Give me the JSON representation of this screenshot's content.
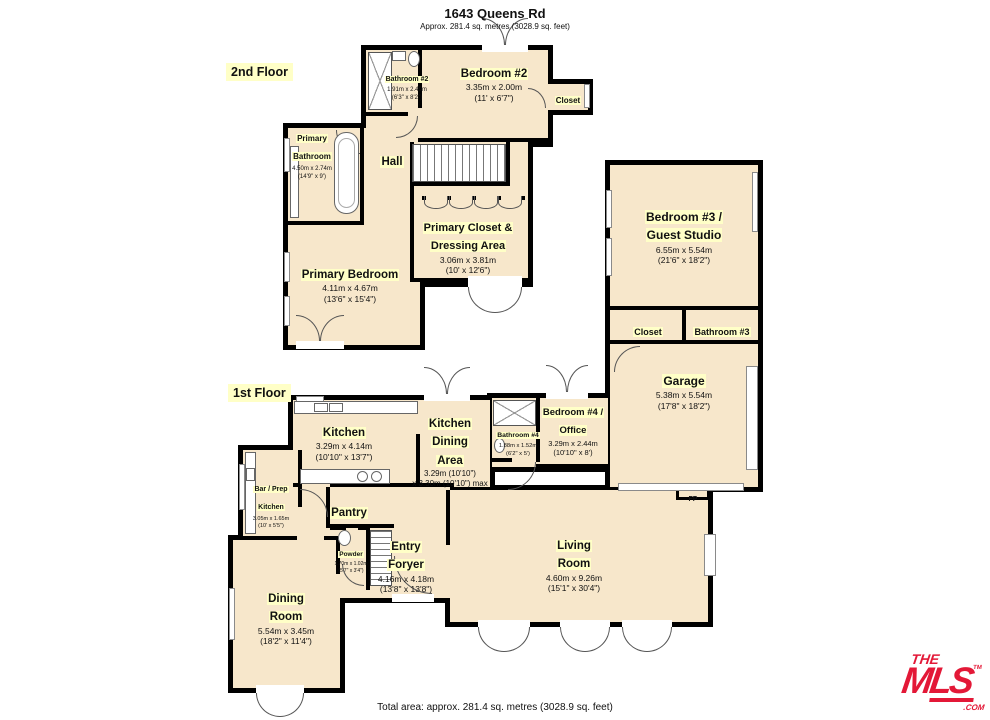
{
  "header": {
    "title": "1643 Queens Rd",
    "subtitle": "Approx. 281.4 sq. metres (3028.9 sq. feet)"
  },
  "floor_labels": {
    "second": "2nd Floor",
    "first": "1st Floor"
  },
  "rooms": {
    "bathroom2": {
      "name": "Bathroom #2",
      "dims_m": "1.91m x 2.49m",
      "dims_ft": "(6'3\" x 8'2\")"
    },
    "bedroom2": {
      "name": "Bedroom #2",
      "dims_m": "3.35m x 2.00m",
      "dims_ft": "(11' x 6'7\")"
    },
    "bedroom2_closet": {
      "name": "Closet"
    },
    "primary_bathroom": {
      "name": "Primary Bathroom",
      "dims_m": "4.50m x 2.74m",
      "dims_ft": "(14'9\" x 9')"
    },
    "hall": {
      "name": "Hall"
    },
    "primary_closet": {
      "name": "Primary Closet & Dressing Area",
      "dims_m": "3.06m x 3.81m",
      "dims_ft": "(10' x 12'6\")"
    },
    "primary_bedroom": {
      "name": "Primary Bedroom",
      "dims_m": "4.11m x 4.67m",
      "dims_ft": "(13'6\" x 15'4\")"
    },
    "bedroom3": {
      "name": "Bedroom #3 / Guest Studio",
      "dims_m": "6.55m x 5.54m",
      "dims_ft": "(21'6\" x 18'2\")"
    },
    "bedroom3_closet": {
      "name": "Closet"
    },
    "bathroom3": {
      "name": "Bathroom #3"
    },
    "garage": {
      "name": "Garage",
      "dims_m": "5.38m x 5.54m",
      "dims_ft": "(17'8\" x 18'2\")"
    },
    "kitchen": {
      "name": "Kitchen",
      "dims_m": "3.29m x 4.14m",
      "dims_ft": "(10'10\" x 13'7\")"
    },
    "kitchen_dining": {
      "name": "Kitchen Dining Area",
      "dims_m": "3.29m (10'10\")",
      "dims_ft": "x 3.30m (10'10\") max"
    },
    "bathroom4": {
      "name": "Bathroom #4",
      "dims_m": "1.88m x 1.52m",
      "dims_ft": "(6'2\" x 5')"
    },
    "bedroom4": {
      "name": "Bedroom #4 / Office",
      "dims_m": "3.29m x 2.44m",
      "dims_ft": "(10'10\" x 8')"
    },
    "bar_prep_kitchen": {
      "name": "Bar / Prep Kitchen",
      "dims_m": "3.05m x 1.65m",
      "dims_ft": "(10' x 5'5\")"
    },
    "pantry": {
      "name": "Pantry"
    },
    "powder": {
      "name": "Powder",
      "dims_m": "1.70m x 1.02m",
      "dims_ft": "(5'7\" x 3'4\")"
    },
    "entry_foyer": {
      "name": "Entry Foryer",
      "dims_m": "4.16m x 4.18m",
      "dims_ft": "(13'8\" x 13'8\")"
    },
    "living_room": {
      "name": "Living Room",
      "dims_m": "4.60m x 9.26m",
      "dims_ft": "(15'1\" x 30'4\")"
    },
    "dining_room": {
      "name": "Dining Room",
      "dims_m": "5.54m x 3.45m",
      "dims_ft": "(18'2\" x 11'4\")"
    }
  },
  "annotations": {
    "fireplace": "FP"
  },
  "footer": {
    "total_area": "Total area: approx. 281.4 sq. metres (3028.9 sq. feet)"
  },
  "logo": {
    "the": "THE",
    "mls": "MLS",
    "tm": "TM",
    "com": ".COM"
  },
  "colors": {
    "room_fill": "#F7E7CB",
    "wall": "#000000",
    "label_highlight": "#FFFFC7",
    "logo_red": "#E31837"
  }
}
